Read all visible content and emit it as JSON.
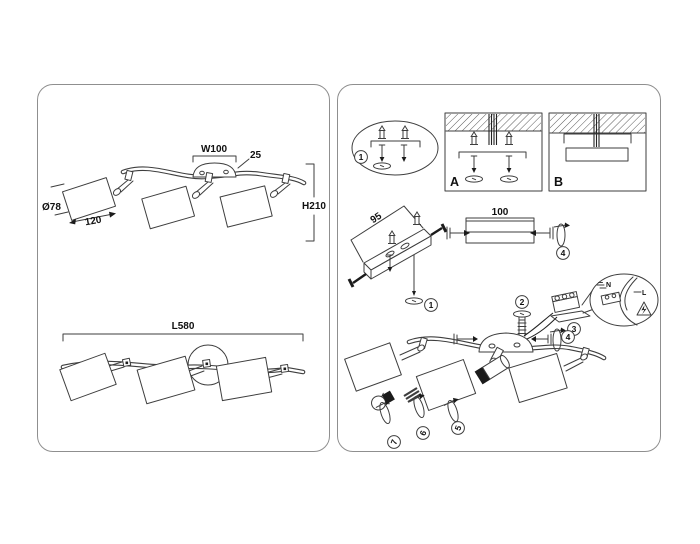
{
  "page": {
    "background": "#ffffff",
    "panel_border": "#8f8f8f",
    "line_color": "#3e3e3e"
  },
  "left_panel": {
    "front_view": {
      "canopy_width": "W100",
      "canopy_height": "25",
      "shade_diameter": "Ø78",
      "shade_length": "120",
      "fixture_height": "H210"
    },
    "top_view": {
      "total_length": "L580"
    }
  },
  "right_panel": {
    "steps": {
      "s1": "1",
      "s2": "2",
      "s3": "3",
      "s4": "4",
      "s5": "5",
      "s6": "6",
      "s7": "7"
    },
    "mounting": {
      "option_a": "A",
      "option_b": "B"
    },
    "bracket_length": "95",
    "connector_length": "100",
    "wiring": {
      "neutral": "N",
      "live": "L",
      "warning_icon": "high-voltage-warning"
    }
  }
}
